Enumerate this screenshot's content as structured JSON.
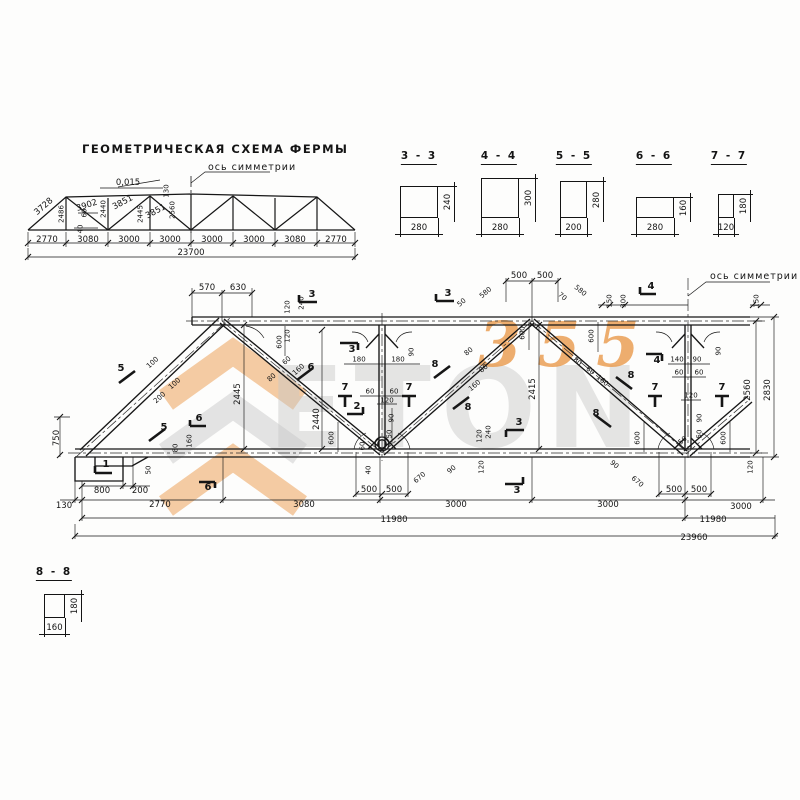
{
  "schema": {
    "title": "ГЕОМЕТРИЧЕСКАЯ СХЕМА ФЕРМЫ",
    "axis_label": "ось симметрии"
  },
  "truss": {
    "axis_label": "ось симметрии"
  },
  "sections": [
    {
      "name": "3 - 3",
      "width": "280",
      "height": "240"
    },
    {
      "name": "4 - 4",
      "width": "280",
      "height": "300"
    },
    {
      "name": "5 - 5",
      "width": "200",
      "height": "280"
    },
    {
      "name": "6 - 6",
      "width": "280",
      "height": "160"
    },
    {
      "name": "7 - 7",
      "width": "120",
      "height": "180"
    },
    {
      "name": "8 - 8",
      "width": "160",
      "height": "180"
    }
  ],
  "watermark": {
    "word": "ETON",
    "digits": "355",
    "orange": "#ea9a4b",
    "gray": "#c7c7c7"
  },
  "dim_labels": [
    {
      "t": "3728",
      "x": 44,
      "y": 207,
      "r": -41
    },
    {
      "t": "2486",
      "x": 62,
      "y": 214,
      "r": -90,
      "fs": 7
    },
    {
      "t": "3902",
      "x": 87,
      "y": 206,
      "r": -18
    },
    {
      "t": "2440",
      "x": 104,
      "y": 209,
      "r": -90,
      "fs": 7
    },
    {
      "t": "3851",
      "x": 123,
      "y": 203,
      "r": -28
    },
    {
      "t": "2445",
      "x": 141,
      "y": 214,
      "r": -90,
      "fs": 7
    },
    {
      "t": "3851",
      "x": 156,
      "y": 212,
      "r": -28
    },
    {
      "t": "2560",
      "x": 173,
      "y": 210,
      "r": -90,
      "fs": 7
    },
    {
      "t": "0,015",
      "x": 128,
      "y": 183
    },
    {
      "t": "130",
      "x": 167,
      "y": 191,
      "r": -90,
      "fs": 7
    },
    {
      "t": "60",
      "x": 85,
      "y": 213,
      "r": -90,
      "fs": 7
    },
    {
      "t": "40",
      "x": 81,
      "y": 229,
      "r": -90,
      "fs": 7
    },
    {
      "t": "2770",
      "x": 47,
      "y": 240
    },
    {
      "t": "3080",
      "x": 88,
      "y": 240
    },
    {
      "t": "3000",
      "x": 129,
      "y": 240
    },
    {
      "t": "3000",
      "x": 170,
      "y": 240
    },
    {
      "t": "3000",
      "x": 212,
      "y": 240
    },
    {
      "t": "3000",
      "x": 254,
      "y": 240
    },
    {
      "t": "3080",
      "x": 295,
      "y": 240
    },
    {
      "t": "2770",
      "x": 336,
      "y": 240
    },
    {
      "t": "23700",
      "x": 191,
      "y": 253
    },
    {
      "t": "570",
      "x": 207,
      "y": 288
    },
    {
      "t": "630",
      "x": 238,
      "y": 288
    },
    {
      "t": "500",
      "x": 519,
      "y": 276
    },
    {
      "t": "500",
      "x": 545,
      "y": 276
    },
    {
      "t": "580",
      "x": 486,
      "y": 293,
      "r": -40,
      "fs": 7
    },
    {
      "t": "580",
      "x": 580,
      "y": 291,
      "r": 40,
      "fs": 7
    },
    {
      "t": "50",
      "x": 462,
      "y": 303,
      "r": -40,
      "fs": 7
    },
    {
      "t": "70",
      "x": 562,
      "y": 297,
      "r": 40,
      "fs": 7
    },
    {
      "t": "150",
      "x": 610,
      "y": 301,
      "r": -90,
      "fs": 7
    },
    {
      "t": "300",
      "x": 624,
      "y": 301,
      "r": -90,
      "fs": 7
    },
    {
      "t": "150",
      "x": 757,
      "y": 301,
      "r": -90,
      "fs": 7
    },
    {
      "t": "120",
      "x": 288,
      "y": 307,
      "r": -90,
      "fs": 7
    },
    {
      "t": "240",
      "x": 302,
      "y": 303,
      "r": -90,
      "fs": 7
    },
    {
      "t": "120",
      "x": 288,
      "y": 336,
      "r": -90,
      "fs": 7
    },
    {
      "t": "600",
      "x": 280,
      "y": 342,
      "r": -90,
      "fs": 7
    },
    {
      "t": "100",
      "x": 153,
      "y": 363,
      "r": -42,
      "fs": 7
    },
    {
      "t": "100",
      "x": 175,
      "y": 384,
      "r": -42,
      "fs": 7
    },
    {
      "t": "200",
      "x": 160,
      "y": 398,
      "r": -42,
      "fs": 7
    },
    {
      "t": "80",
      "x": 272,
      "y": 378,
      "r": -42,
      "fs": 7
    },
    {
      "t": "60",
      "x": 287,
      "y": 361,
      "r": -42,
      "fs": 7
    },
    {
      "t": "160",
      "x": 299,
      "y": 370,
      "r": -42,
      "fs": 7
    },
    {
      "t": "2445",
      "x": 238,
      "y": 394,
      "r": -90
    },
    {
      "t": "180",
      "x": 359,
      "y": 360,
      "fs": 7
    },
    {
      "t": "180",
      "x": 398,
      "y": 360,
      "fs": 7
    },
    {
      "t": "90",
      "x": 412,
      "y": 352,
      "r": -90,
      "fs": 7
    },
    {
      "t": "60",
      "x": 370,
      "y": 392,
      "fs": 7
    },
    {
      "t": "60",
      "x": 394,
      "y": 392,
      "fs": 7
    },
    {
      "t": "120",
      "x": 387,
      "y": 401,
      "fs": 7
    },
    {
      "t": "90",
      "x": 392,
      "y": 418,
      "r": -90,
      "fs": 7
    },
    {
      "t": "50",
      "x": 390,
      "y": 434,
      "r": -90,
      "fs": 7
    },
    {
      "t": "2440",
      "x": 317,
      "y": 419,
      "r": -90
    },
    {
      "t": "600",
      "x": 332,
      "y": 438,
      "r": -90,
      "fs": 7
    },
    {
      "t": "60",
      "x": 363,
      "y": 446,
      "r": -90,
      "fs": 7
    },
    {
      "t": "40",
      "x": 369,
      "y": 470,
      "r": -90,
      "fs": 7
    },
    {
      "t": "500",
      "x": 369,
      "y": 490
    },
    {
      "t": "500",
      "x": 394,
      "y": 490
    },
    {
      "t": "670",
      "x": 420,
      "y": 478,
      "r": -40,
      "fs": 7
    },
    {
      "t": "90",
      "x": 452,
      "y": 470,
      "r": -40,
      "fs": 7
    },
    {
      "t": "120",
      "x": 480,
      "y": 436,
      "r": -90,
      "fs": 7
    },
    {
      "t": "240",
      "x": 489,
      "y": 432,
      "r": -90,
      "fs": 7
    },
    {
      "t": "120",
      "x": 482,
      "y": 467,
      "r": -90,
      "fs": 7
    },
    {
      "t": "80",
      "x": 469,
      "y": 352,
      "r": -40,
      "fs": 7
    },
    {
      "t": "80",
      "x": 484,
      "y": 369,
      "r": -40,
      "fs": 7
    },
    {
      "t": "160",
      "x": 475,
      "y": 386,
      "r": -40,
      "fs": 7
    },
    {
      "t": "80",
      "x": 577,
      "y": 362,
      "r": 40,
      "fs": 7
    },
    {
      "t": "60",
      "x": 590,
      "y": 371,
      "r": 40,
      "fs": 7
    },
    {
      "t": "160",
      "x": 602,
      "y": 381,
      "r": 40,
      "fs": 7
    },
    {
      "t": "600",
      "x": 592,
      "y": 336,
      "r": -90,
      "fs": 7
    },
    {
      "t": "600",
      "x": 523,
      "y": 333,
      "r": -90,
      "fs": 7
    },
    {
      "t": "2415",
      "x": 533,
      "y": 389,
      "r": -90
    },
    {
      "t": "140",
      "x": 677,
      "y": 360,
      "fs": 7
    },
    {
      "t": "90",
      "x": 697,
      "y": 360,
      "fs": 7
    },
    {
      "t": "90",
      "x": 719,
      "y": 351,
      "r": -90,
      "fs": 7
    },
    {
      "t": "60",
      "x": 679,
      "y": 373,
      "fs": 7
    },
    {
      "t": "60",
      "x": 699,
      "y": 373,
      "fs": 7
    },
    {
      "t": "120",
      "x": 691,
      "y": 396,
      "fs": 7
    },
    {
      "t": "90",
      "x": 700,
      "y": 418,
      "r": -90,
      "fs": 7
    },
    {
      "t": "50",
      "x": 700,
      "y": 434,
      "r": -90,
      "fs": 7
    },
    {
      "t": "600",
      "x": 638,
      "y": 438,
      "r": -90,
      "fs": 7
    },
    {
      "t": "600",
      "x": 724,
      "y": 438,
      "r": -90,
      "fs": 7
    },
    {
      "t": "90",
      "x": 614,
      "y": 465,
      "r": 40,
      "fs": 7
    },
    {
      "t": "670",
      "x": 637,
      "y": 482,
      "r": 40,
      "fs": 7
    },
    {
      "t": "50",
      "x": 683,
      "y": 441,
      "r": -40,
      "fs": 7
    },
    {
      "t": "500",
      "x": 674,
      "y": 490
    },
    {
      "t": "500",
      "x": 699,
      "y": 490
    },
    {
      "t": "120",
      "x": 751,
      "y": 467,
      "r": -90,
      "fs": 7
    },
    {
      "t": "750",
      "x": 57,
      "y": 438,
      "r": -90
    },
    {
      "t": "130",
      "x": 64,
      "y": 506
    },
    {
      "t": "800",
      "x": 102,
      "y": 491
    },
    {
      "t": "200",
      "x": 140,
      "y": 491
    },
    {
      "t": "50",
      "x": 149,
      "y": 470,
      "r": -90,
      "fs": 7
    },
    {
      "t": "80",
      "x": 176,
      "y": 448,
      "r": -90,
      "fs": 7
    },
    {
      "t": "160",
      "x": 190,
      "y": 441,
      "r": -90,
      "fs": 7
    },
    {
      "t": "2770",
      "x": 160,
      "y": 505
    },
    {
      "t": "3080",
      "x": 304,
      "y": 505
    },
    {
      "t": "3000",
      "x": 456,
      "y": 505
    },
    {
      "t": "3000",
      "x": 608,
      "y": 505
    },
    {
      "t": "3000",
      "x": 741,
      "y": 507
    },
    {
      "t": "11980",
      "x": 394,
      "y": 520
    },
    {
      "t": "11980",
      "x": 713,
      "y": 520
    },
    {
      "t": "23960",
      "x": 694,
      "y": 538
    },
    {
      "t": "2560",
      "x": 748,
      "y": 390,
      "r": -90
    },
    {
      "t": "2830",
      "x": 768,
      "y": 390,
      "r": -90
    },
    {
      "t": "1",
      "x": 106,
      "y": 465,
      "b": 1
    },
    {
      "t": "2",
      "x": 357,
      "y": 407,
      "b": 1
    },
    {
      "t": "3",
      "x": 312,
      "y": 295,
      "b": 1
    },
    {
      "t": "3",
      "x": 448,
      "y": 294,
      "b": 1
    },
    {
      "t": "3",
      "x": 352,
      "y": 350,
      "b": 1
    },
    {
      "t": "3",
      "x": 519,
      "y": 423,
      "b": 1
    },
    {
      "t": "3",
      "x": 517,
      "y": 491,
      "b": 1
    },
    {
      "t": "4",
      "x": 651,
      "y": 287,
      "b": 1
    },
    {
      "t": "4",
      "x": 657,
      "y": 361,
      "b": 1
    },
    {
      "t": "5",
      "x": 121,
      "y": 369,
      "b": 1
    },
    {
      "t": "5",
      "x": 164,
      "y": 428,
      "b": 1
    },
    {
      "t": "6",
      "x": 199,
      "y": 419,
      "b": 1
    },
    {
      "t": "6",
      "x": 208,
      "y": 488,
      "b": 1
    },
    {
      "t": "6",
      "x": 311,
      "y": 368,
      "b": 1
    },
    {
      "t": "7",
      "x": 345,
      "y": 388,
      "b": 1
    },
    {
      "t": "7",
      "x": 409,
      "y": 388,
      "b": 1
    },
    {
      "t": "7",
      "x": 655,
      "y": 388,
      "b": 1
    },
    {
      "t": "7",
      "x": 722,
      "y": 388,
      "b": 1
    },
    {
      "t": "8",
      "x": 435,
      "y": 365,
      "b": 1
    },
    {
      "t": "8",
      "x": 468,
      "y": 408,
      "b": 1
    },
    {
      "t": "8",
      "x": 631,
      "y": 376,
      "b": 1
    },
    {
      "t": "8",
      "x": 596,
      "y": 414,
      "b": 1
    }
  ]
}
